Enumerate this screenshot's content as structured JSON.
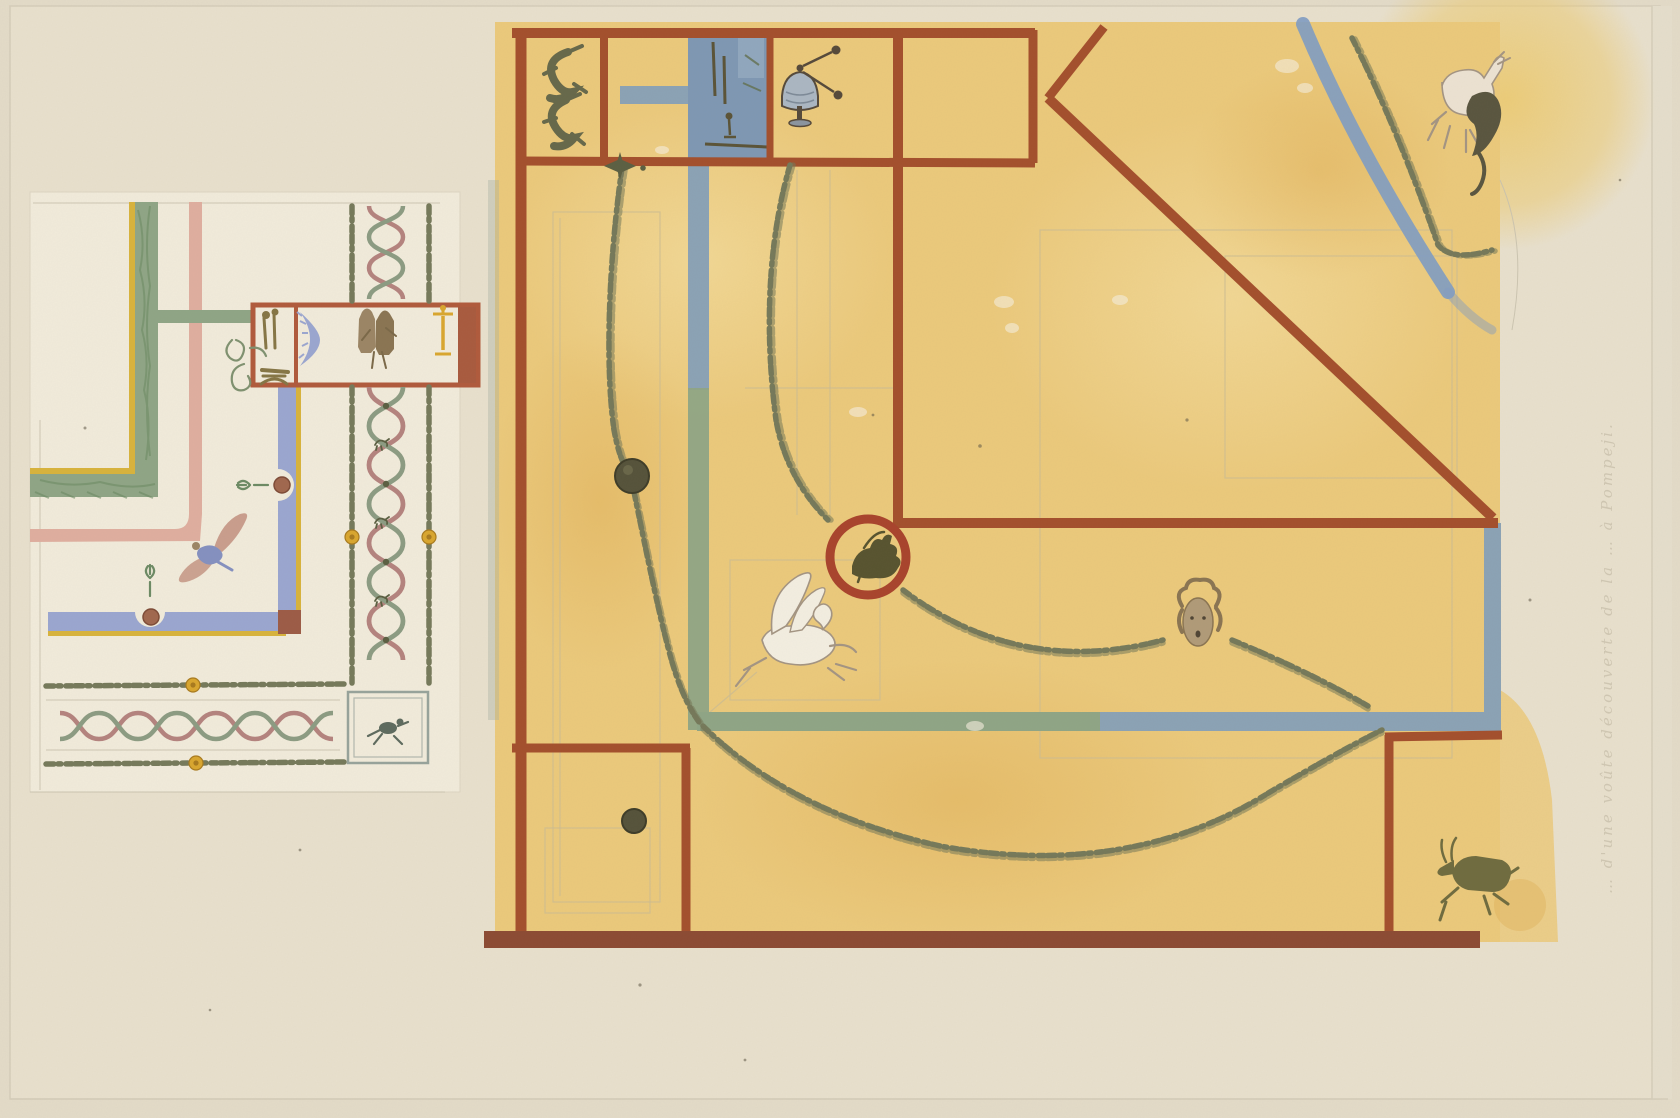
{
  "artwork": {
    "title": "Two watercolor studies of painted Pompeian ceiling decorations",
    "inscription": {
      "text": "… d'une voûte découverte de la … à Pompeji."
    }
  },
  "palette": {
    "paper": "#e8e0cd",
    "paper_outer": "#e3dbc8",
    "paper_edge": "#d5cdba",
    "ground_white": "#f1ebdb",
    "yellow": "#ebc97b",
    "yellow_light": "#f4dc9d",
    "yellow_deep": "#dfb058",
    "red_line": "#a34f2c",
    "red_dark": "#8c4a33",
    "maroon": "#9c5b46",
    "aed_frame": "#b05a3c",
    "blue_band": "#8ba2b5",
    "blue_vignette": "#7e97b3",
    "periwinkle": "#9aa6d0",
    "blue_arc": "#809cc3",
    "sage": "#8fa585",
    "sage_dark": "#6c8a64",
    "olive": "#75795a",
    "olive_dark": "#5b5f42",
    "gold": "#d9a62e",
    "yellow_trim": "#d8b33c",
    "pink": "#dfae9f",
    "rose": "#b4837e",
    "sage_ribbon": "#8c9b82",
    "brown_fig": "#9b8565",
    "tan": "#b09a78",
    "tan_dark": "#8a7452",
    "pale_fig": "#f3eee1",
    "pale_stroke": "#a39482",
    "disc": "#55523a",
    "goat": "#6f6b3f",
    "dark_animal": "#59553f",
    "pencil": "#cdbd92",
    "pencil_gray": "#c9c2ae",
    "inscription": "#c9c0ab"
  },
  "left_study": {
    "ground": "off-white",
    "motifs": [
      "green-foliate-border",
      "pink-border",
      "blue-border-with-medallions",
      "aedicula-frieze",
      "landscape-vignette",
      "blue-crescent",
      "standing-statues",
      "candelabrum",
      "flying-genius",
      "ribbon-twist-band",
      "garland-bands",
      "guilloche-band",
      "satyr-panel",
      "gold-rosettes",
      "scroll-tendril"
    ]
  },
  "right_study": {
    "ground": "yellow-ochre",
    "motifs": [
      "two-dolphins",
      "harbor-vignette",
      "tripod-bell",
      "hanging-garland",
      "ivy-swags",
      "laurel-arc",
      "blue-arc",
      "stag-attacked-by-feline",
      "griffin-medallion",
      "pegasus",
      "mask-with-garland",
      "leaping-goat",
      "paterae-discs",
      "red-frame-lines",
      "blue-border-bands",
      "spindle-ornament"
    ]
  }
}
